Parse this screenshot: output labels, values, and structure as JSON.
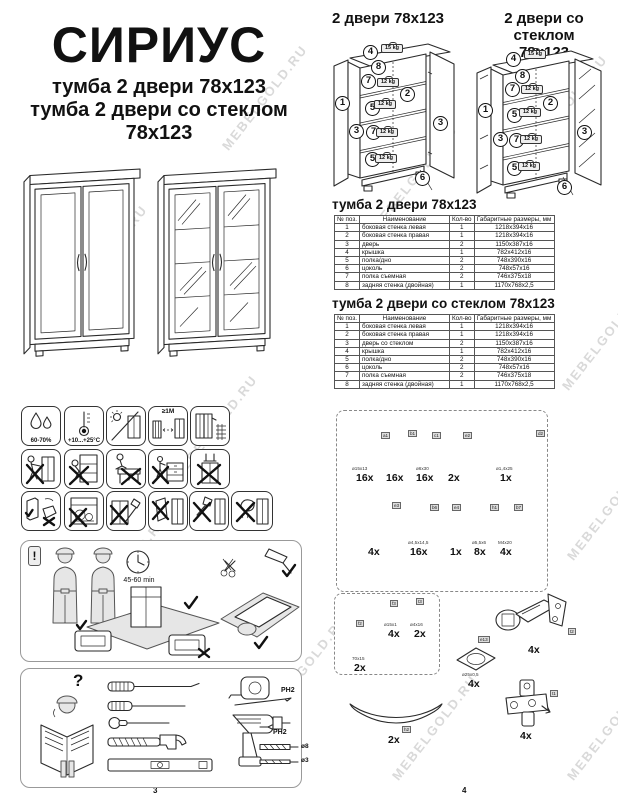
{
  "watermark": "MEBELGOLD.RU",
  "header": {
    "brand": "СИРИУС",
    "subtitle1": "тумба 2 двери 78х123",
    "subtitle2": "тумба 2 двери со стеклом 78х123"
  },
  "exploded": {
    "left_title": "2 двери 78х123",
    "right_title_line1": "2 двери со стеклом",
    "right_title_line2": "78х123",
    "weight_top": "15 kg",
    "weight_shelf": "12 kg",
    "callouts": [
      "4",
      "8",
      "7",
      "2",
      "5",
      "1",
      "3",
      "7",
      "3",
      "5",
      "6"
    ]
  },
  "tables": [
    {
      "title": "тумба 2 двери 78х123",
      "headers": [
        "№ поз.",
        "Наименование",
        "Кол-во",
        "Габаритные размеры, мм"
      ],
      "rows": [
        [
          "1",
          "боковая стенка левая",
          "1",
          "1218х394х16"
        ],
        [
          "2",
          "боковая стенка правая",
          "1",
          "1218х394х16"
        ],
        [
          "3",
          "дверь",
          "2",
          "1150х387х16"
        ],
        [
          "4",
          "крышка",
          "1",
          "782х412х16"
        ],
        [
          "5",
          "полка/дно",
          "2",
          "748х390х16"
        ],
        [
          "6",
          "цоколь",
          "2",
          "748х57х16"
        ],
        [
          "7",
          "полка съемная",
          "2",
          "746х375х18"
        ],
        [
          "8",
          "задняя стенка (двойная)",
          "1",
          "1170х768х2,5"
        ]
      ]
    },
    {
      "title": "тумба 2 двери со стеклом 78х123",
      "headers": [
        "№ поз.",
        "Наименование",
        "Кол-во",
        "Габаритные размеры, мм"
      ],
      "rows": [
        [
          "1",
          "боковая стенка левая",
          "1",
          "1218х394х16"
        ],
        [
          "2",
          "боковая стенка правая",
          "1",
          "1218х394х16"
        ],
        [
          "3",
          "дверь со стеклом",
          "2",
          "1150х387х16"
        ],
        [
          "4",
          "крышка",
          "1",
          "782х412х16"
        ],
        [
          "5",
          "полка/дно",
          "2",
          "748х390х16"
        ],
        [
          "6",
          "цоколь",
          "2",
          "748х57х16"
        ],
        [
          "7",
          "полка съемная",
          "2",
          "746х375х18"
        ],
        [
          "8",
          "задняя стенка (двойная)",
          "1",
          "1170х768х2,5"
        ]
      ]
    }
  ],
  "care": {
    "humidity": "60-70%",
    "temperature": "+10...+25°C",
    "distance": "≥1M"
  },
  "assembly": {
    "exclaim": "!",
    "time": "45-60 min"
  },
  "tools": {
    "question": "?",
    "ph2": "PH2",
    "bit_ph2": "PH2",
    "d8": "ø8",
    "d3": "ø3"
  },
  "hardware": {
    "row1": [
      {
        "tag": "a1",
        "size": "ø15х13",
        "qty": "16x"
      },
      {
        "tag": "b1",
        "size": "",
        "qty": "16x"
      },
      {
        "tag": "c1",
        "size": "ø6х30",
        "qty": "16x"
      },
      {
        "tag": "e2",
        "size": "",
        "qty": "2x"
      },
      {
        "tag": "d2",
        "size": "ø1,4х25",
        "qty": "1x"
      }
    ],
    "row2": [
      {
        "tag": "e3",
        "size": "",
        "qty": "4x"
      },
      {
        "tag": "b6",
        "size": "ø4,5х14,5",
        "qty": "16x"
      },
      {
        "tag": "e4",
        "size": "",
        "qty": "1x"
      },
      {
        "tag": "h1",
        "size": "ø5,5х6",
        "qty": "8x"
      },
      {
        "tag": "b7",
        "size": "M4х20",
        "qty": "4x"
      }
    ],
    "bracket": {
      "tag": "f2",
      "size": "70х15",
      "qty": "2x"
    },
    "washer": {
      "tag": "f3",
      "size": "ø15х1",
      "qty": "4x"
    },
    "bracket_screw": {
      "tag": "t3",
      "size": "ø4х16",
      "qty": "2x"
    },
    "pad": {
      "tag": "e13",
      "size": "ø25х0,5",
      "qty": "4x"
    },
    "hinge": {
      "tag": "t2",
      "qty": "4x"
    },
    "strip": {
      "tag": "h2",
      "qty": "2x"
    },
    "hinge_plate": {
      "tag": "t1",
      "qty": "4x"
    }
  },
  "page_numbers": {
    "left": "3",
    "tables": "2",
    "hardware": "4"
  }
}
